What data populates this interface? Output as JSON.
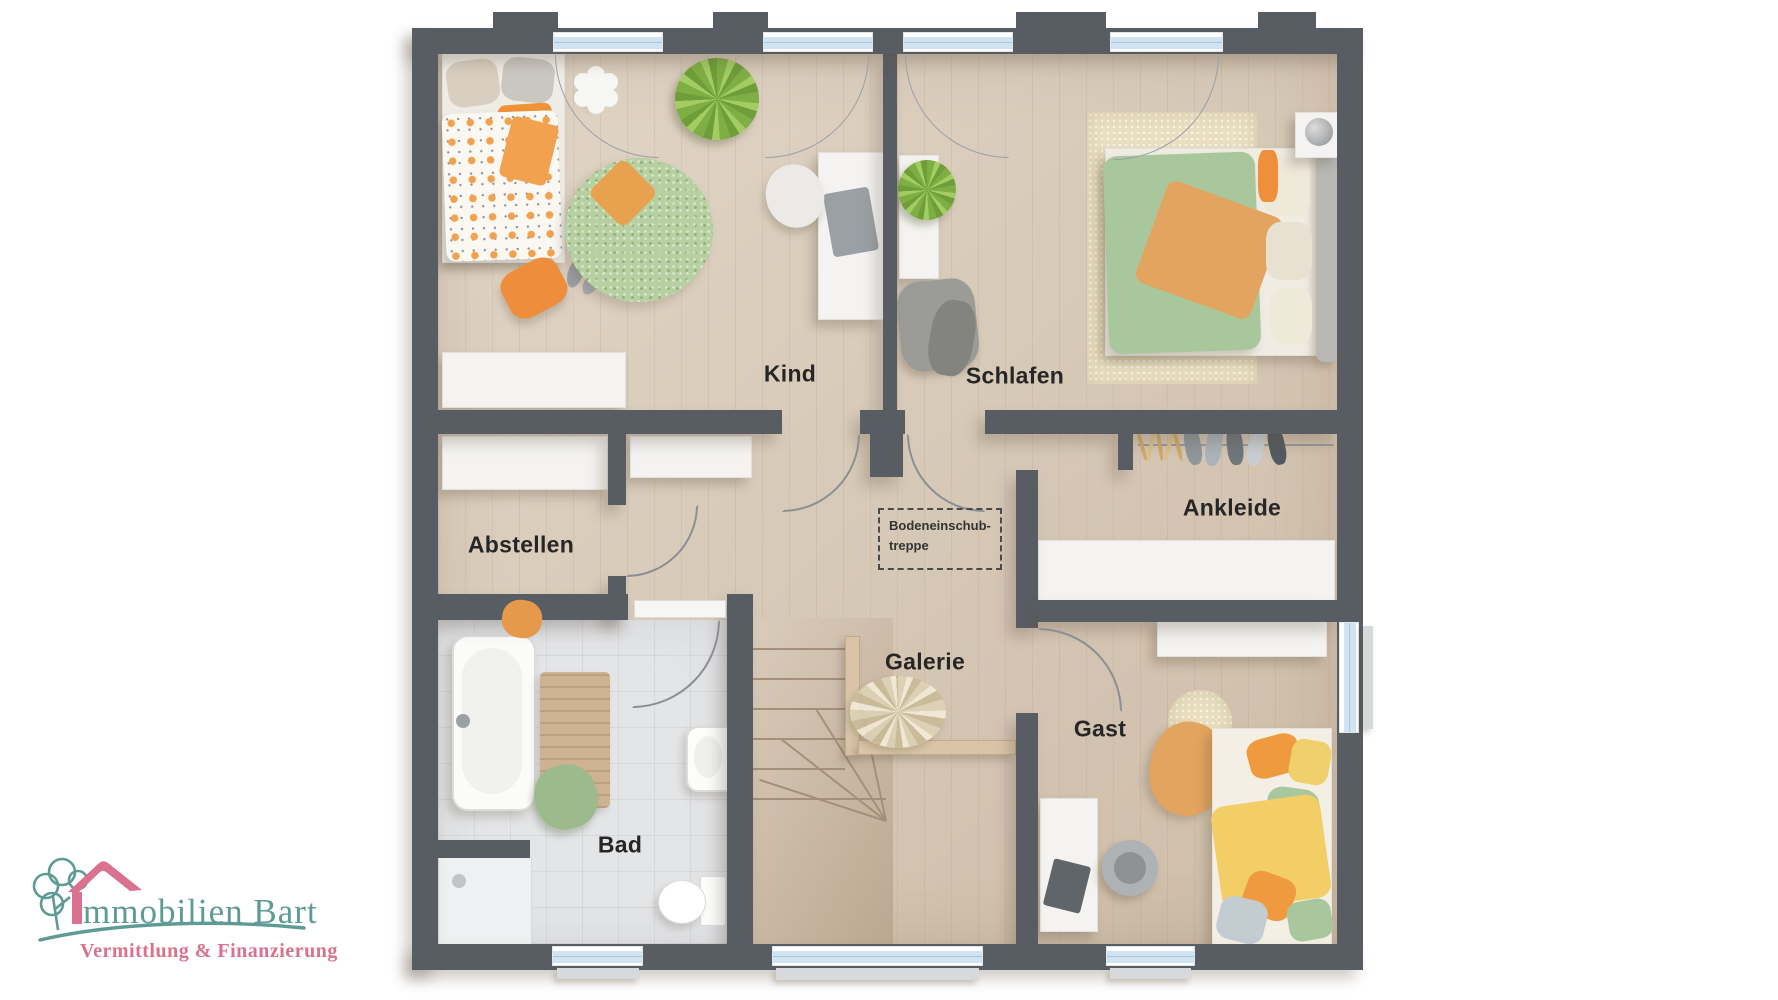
{
  "floorplan": {
    "type": "residential-upper-floor-plan",
    "rooms": [
      {
        "id": "kind",
        "label": "Kind"
      },
      {
        "id": "schlafen",
        "label": "Schlafen"
      },
      {
        "id": "abstellen",
        "label": "Abstellen"
      },
      {
        "id": "ankleide",
        "label": "Ankleide"
      },
      {
        "id": "galerie",
        "label": "Galerie"
      },
      {
        "id": "gast",
        "label": "Gast"
      },
      {
        "id": "bad",
        "label": "Bad"
      }
    ],
    "annotation": {
      "line1": "Bodeneinschub-",
      "line2": "treppe"
    },
    "colors": {
      "wall": "#585d64",
      "floor_wood": "#d9cab7",
      "floor_tile": "#e4e5e7",
      "stairs_wood": "#cdbaa4",
      "window_glass": "#cfe4f0",
      "accent_orange": "#ef9f4a",
      "accent_green": "#a9c79c",
      "rug_beige": "#e9dfc0"
    }
  },
  "logo": {
    "brand": "Immobilien Bart",
    "brand_visible_rest": "mmobilien Bart",
    "tagline": "Vermittlung & Finanzierung",
    "colors": {
      "teal": "#5d9b94",
      "pink": "#d9718f"
    }
  }
}
